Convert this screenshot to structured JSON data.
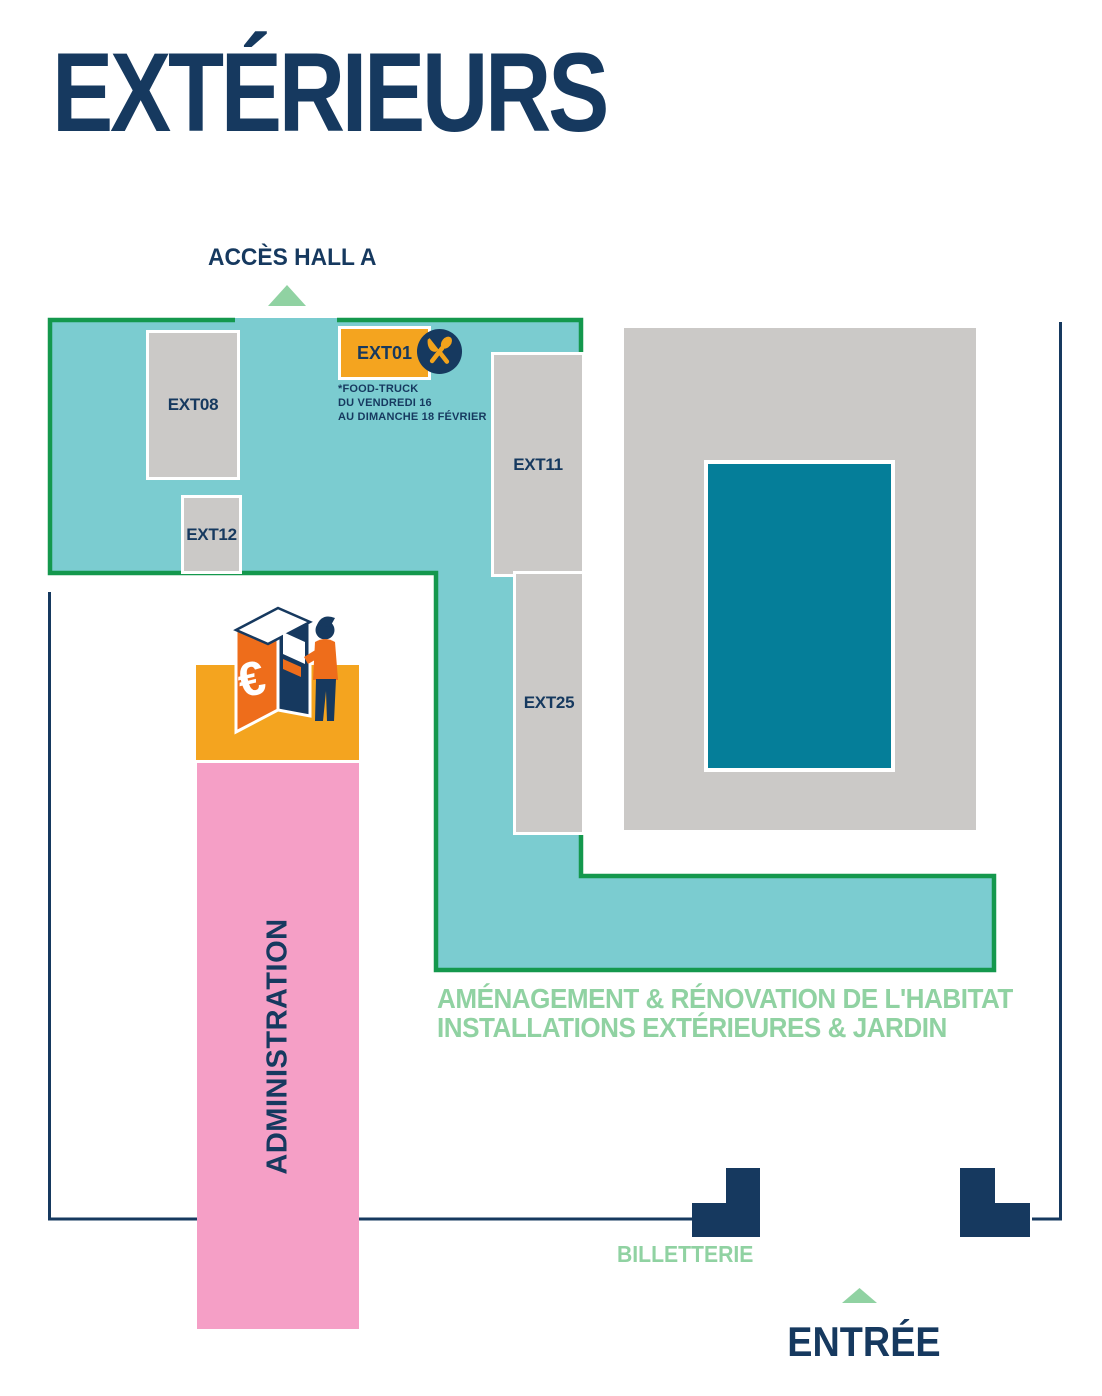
{
  "page": {
    "title": "EXTÉRIEURS"
  },
  "access": {
    "label": "ACCÈS HALL A"
  },
  "booths": [
    {
      "id": "EXT01",
      "label": "EXT01",
      "note": "food-truck location"
    },
    {
      "id": "EXT08",
      "label": "EXT08"
    },
    {
      "id": "EXT12",
      "label": "EXT12"
    },
    {
      "id": "EXT11",
      "label": "EXT11"
    },
    {
      "id": "EXT25",
      "label": "EXT25"
    }
  ],
  "foodtruck": {
    "line1": "*FOOD-TRUCK",
    "line2": "DU VENDREDI 16",
    "line3": "AU DIMANCHE 18 FÉVRIER"
  },
  "zone_caption": {
    "line1": "AMÉNAGEMENT & RÉNOVATION DE L'HABITAT",
    "line2": "INSTALLATIONS EXTÉRIEURES & JARDIN"
  },
  "admin": {
    "label": "ADMINISTRATION"
  },
  "billetterie": {
    "label": "BILLETTERIE"
  },
  "entree": {
    "label": "ENTRÉE"
  },
  "atm": {
    "currency_symbol": "€"
  },
  "colors": {
    "navy": "#16395f",
    "teal": "#7bccd0",
    "teal_dark": "#057e99",
    "green_border": "#14984d",
    "green_light": "#90d2a2",
    "orange": "#f4a41f",
    "orange_deep": "#ee6d1b",
    "pink": "#f59fc6",
    "gray": "#cbc9c7"
  }
}
